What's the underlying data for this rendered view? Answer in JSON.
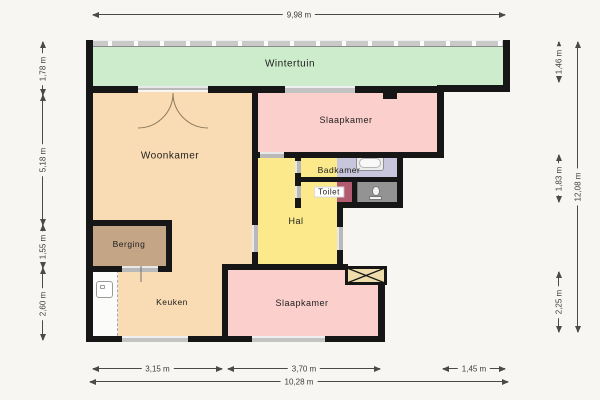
{
  "plan_type": "floorplan",
  "rooms": {
    "wintertuin": {
      "label": "Wintertuin",
      "color": "#cdeccb"
    },
    "woonkamer": {
      "label": "Woonkamer",
      "color": "#fadcb4"
    },
    "slaapkamer_top": {
      "label": "Slaapkamer",
      "color": "#fbcfcc"
    },
    "badkamer": {
      "label": "Badkamer",
      "color": "#c7c6dd"
    },
    "toilet": {
      "label": "Toilet",
      "color": "#b25a70"
    },
    "hal": {
      "label": "Hal",
      "color": "#fbe98b"
    },
    "berging": {
      "label": "Berging",
      "color": "#c4a687"
    },
    "keuken": {
      "label": "Keuken",
      "color": "#fadcb4"
    },
    "slaapkamer_bottom": {
      "label": "Slaapkamer",
      "color": "#fbcfcc"
    },
    "shower_area": {
      "color": "#939393"
    },
    "shaft": {
      "color": "#eeddab"
    }
  },
  "fixtures": [
    "bathtub-icon",
    "toilet-bowl-icon",
    "kitchen-sink-icon",
    "double-door-icon"
  ],
  "dimensions": {
    "top": {
      "total": "9,98 m"
    },
    "bottom": {
      "seg1": "3,15 m",
      "seg2": "3,70 m",
      "seg3": "1,45 m",
      "total": "10,28 m"
    },
    "left": {
      "seg1": "1,78 m",
      "seg2": "5,18 m",
      "seg3": "1,55 m",
      "seg4": "2,60 m"
    },
    "right": {
      "seg1": "1,46 m",
      "seg2": "1,83 m",
      "seg3": "2,25 m",
      "total": "12,08 m"
    }
  },
  "colors": {
    "background": "#f7f6f3",
    "wall": "#161616",
    "window": "#c3c3c3",
    "door": "#b9b9b9",
    "dimension_line": "#4a4a4a"
  }
}
